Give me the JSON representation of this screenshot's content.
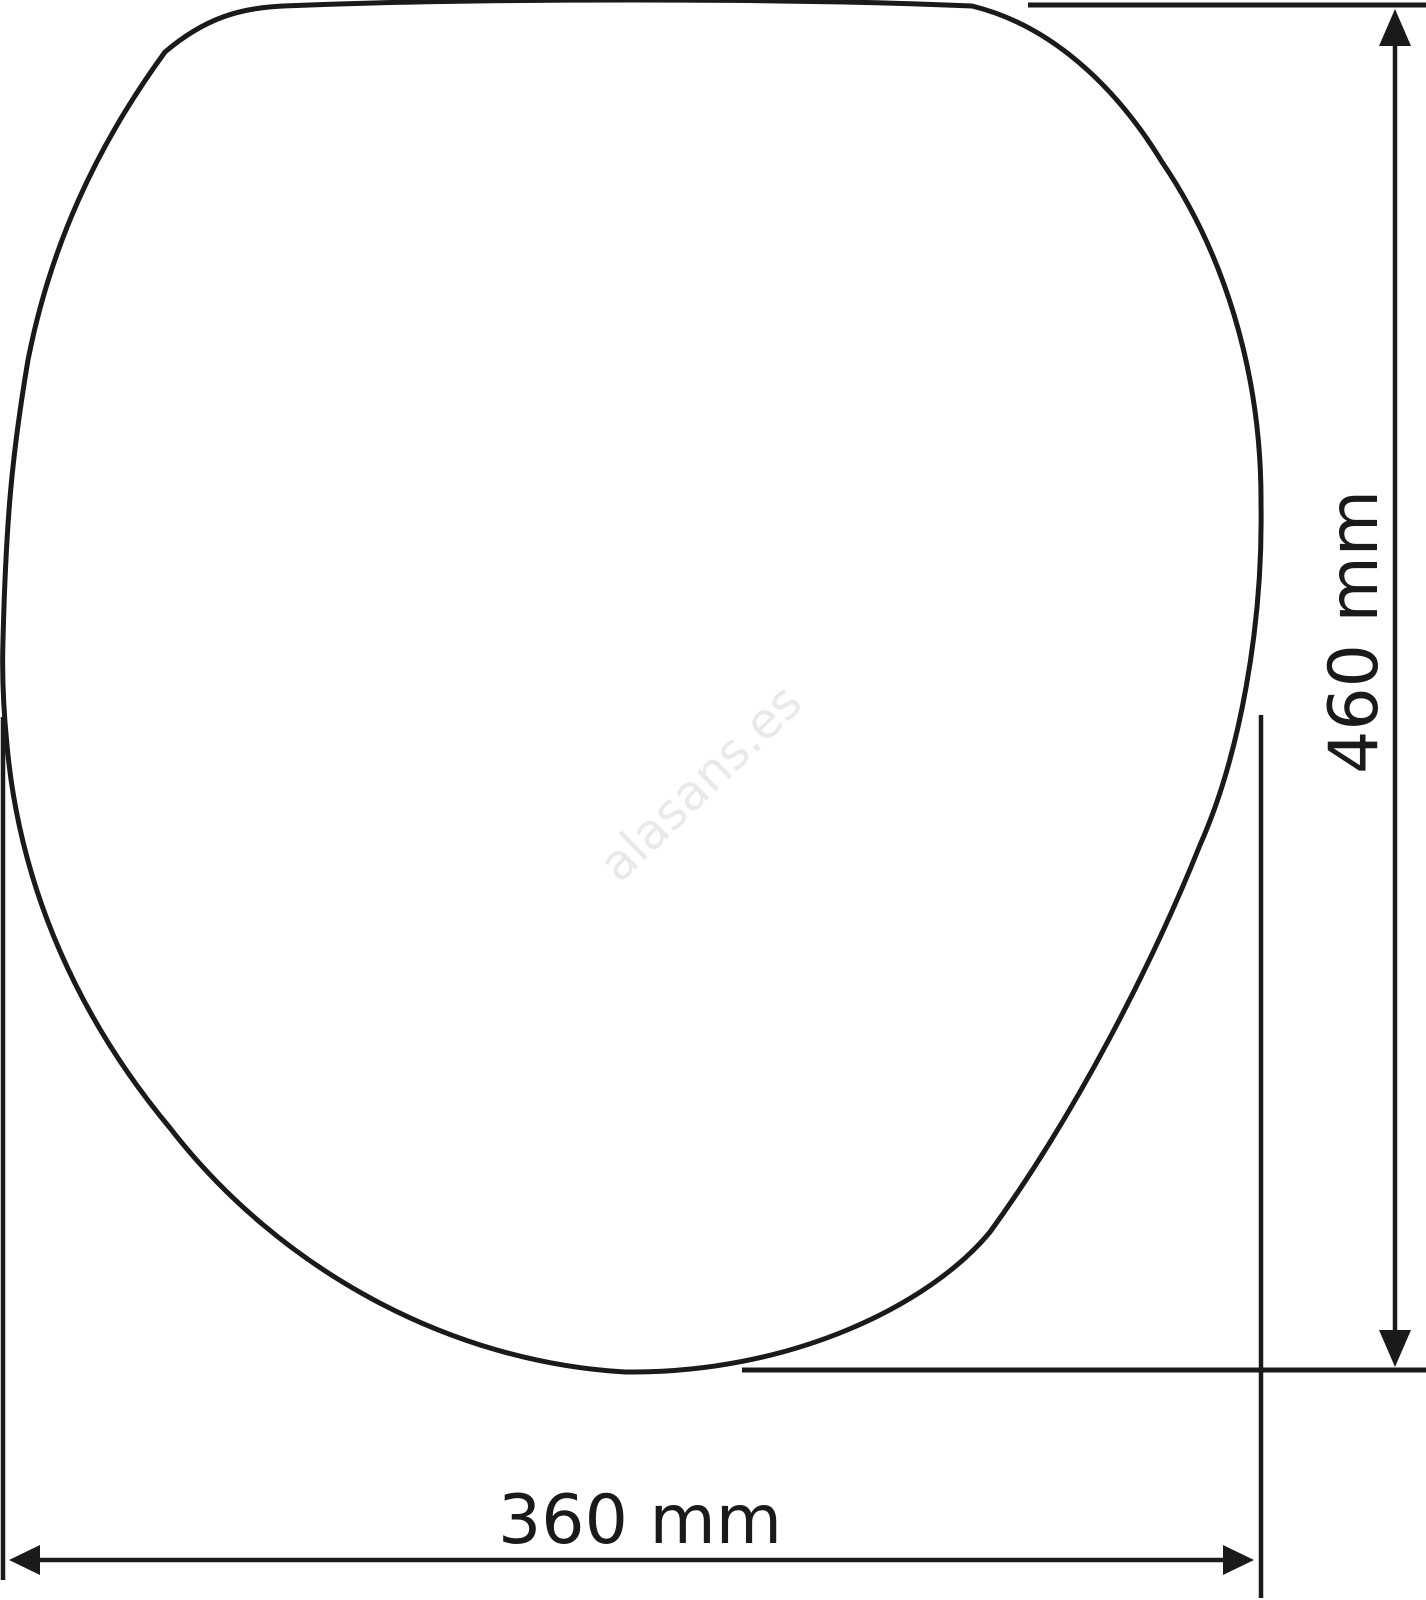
{
  "diagram": {
    "height_dimension": {
      "label": "460 mm"
    },
    "width_dimension": {
      "label": "360 mm"
    },
    "watermark": {
      "text": "alasans.es"
    },
    "colors": {
      "line": "#1a1a1a",
      "watermark": "#e9e9e9",
      "background": "#ffffff"
    }
  }
}
